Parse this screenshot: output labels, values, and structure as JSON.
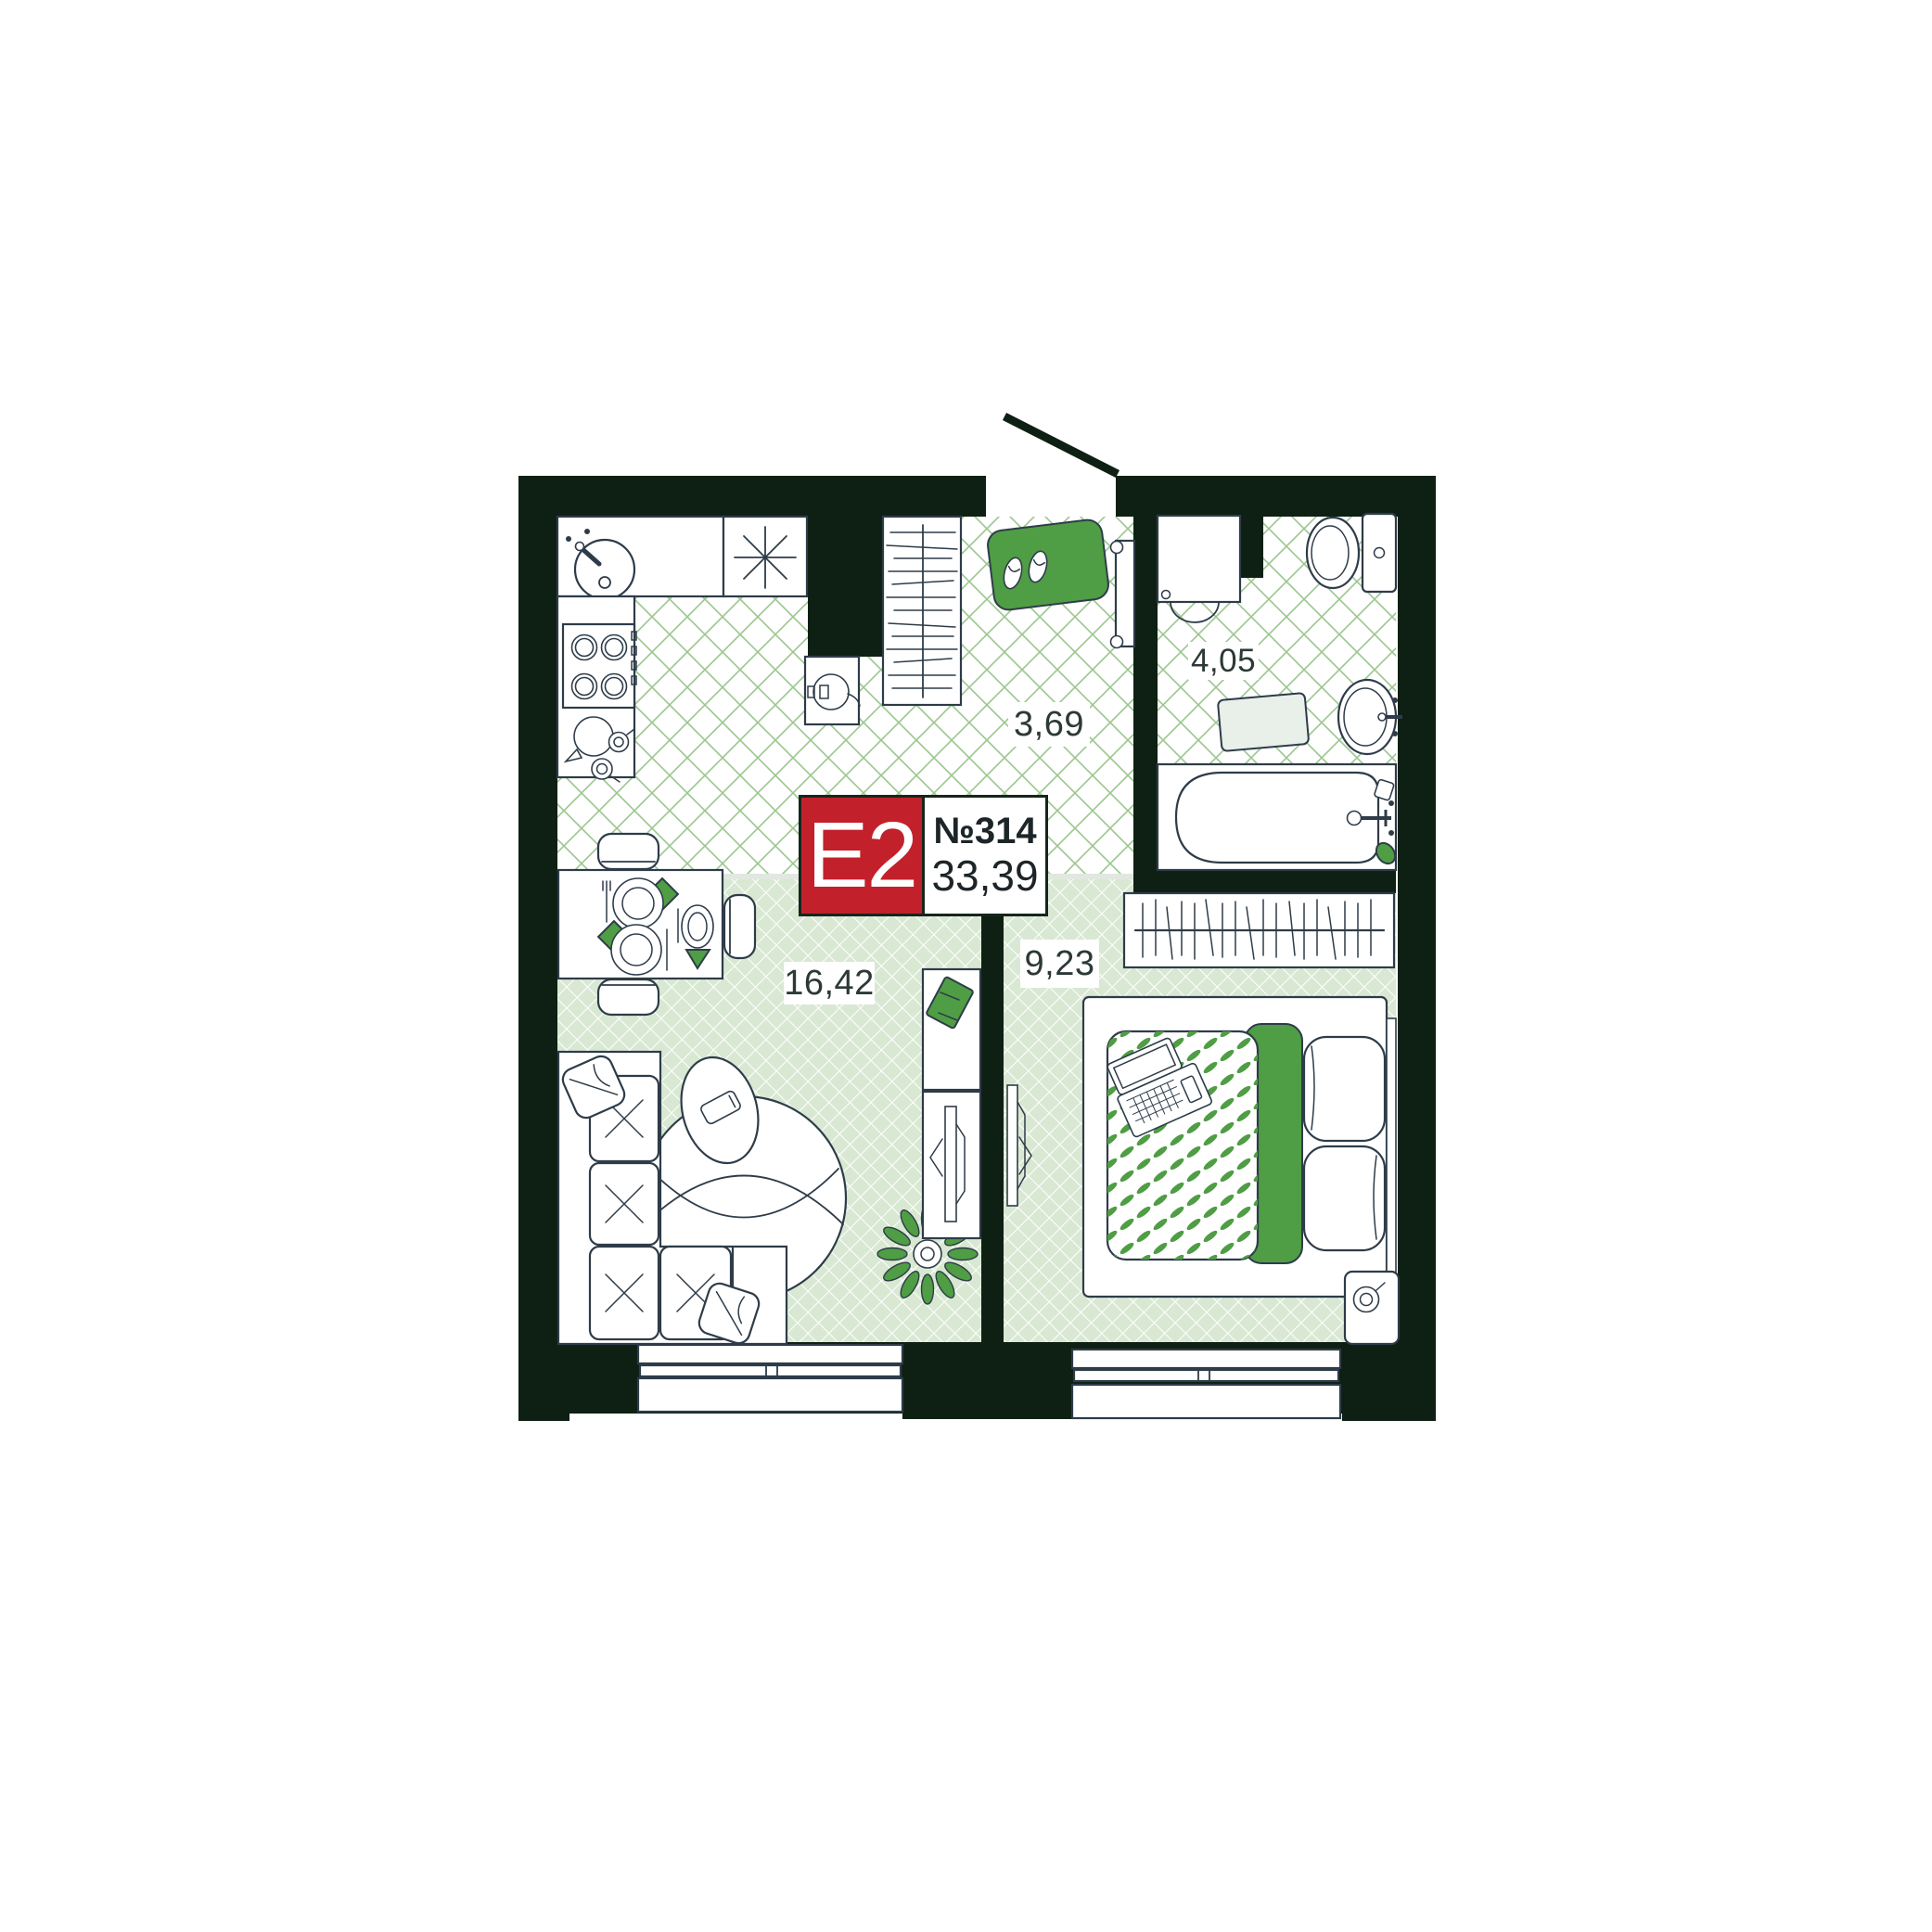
{
  "floor_plan": {
    "unit_type_label": "E2",
    "unit_number": "№314",
    "total_area": "33,39",
    "rooms": [
      {
        "name": "kitchen-living-room",
        "area": "16,42"
      },
      {
        "name": "bedroom",
        "area": "9,23"
      },
      {
        "name": "hallway",
        "area": "3,69"
      },
      {
        "name": "bathroom",
        "area": "4,05"
      }
    ],
    "colors": {
      "walls": "#0d2013",
      "badge_red": "#c2212b",
      "accent_green": "#4f9d44",
      "floor_tint_green": "#d9e8d3",
      "lattice_line_green": "#9cc68f",
      "furniture_outline": "#2e3c49"
    }
  }
}
